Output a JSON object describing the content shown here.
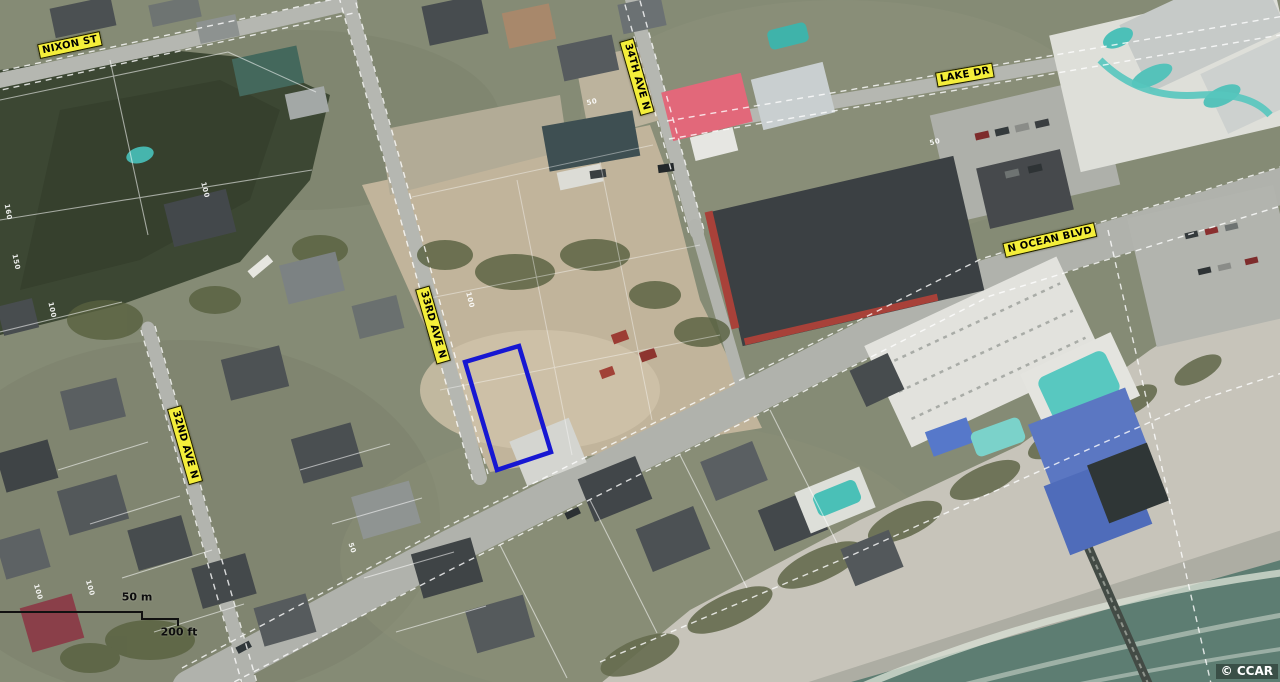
{
  "map": {
    "type": "aerial-parcel-map",
    "streets": [
      {
        "name": "NIXON ST"
      },
      {
        "name": "34TH AVE N"
      },
      {
        "name": "LAKE DR"
      },
      {
        "name": "N OCEAN BLVD"
      },
      {
        "name": "33RD AVE N"
      },
      {
        "name": "32ND AVE N"
      }
    ],
    "scale_bar": {
      "metric_label": "50 m",
      "imperial_label": "200 ft"
    },
    "copyright": "© CCAR",
    "highlight_parcel": {
      "outline_color": "#1717d2"
    },
    "label_style": {
      "background": "#f4ee3a",
      "border": "#191900",
      "text": "#000000"
    },
    "lot_numbers": [
      "100",
      "160",
      "150",
      "100",
      "100",
      "100",
      "50",
      "100",
      "50",
      "50"
    ]
  }
}
